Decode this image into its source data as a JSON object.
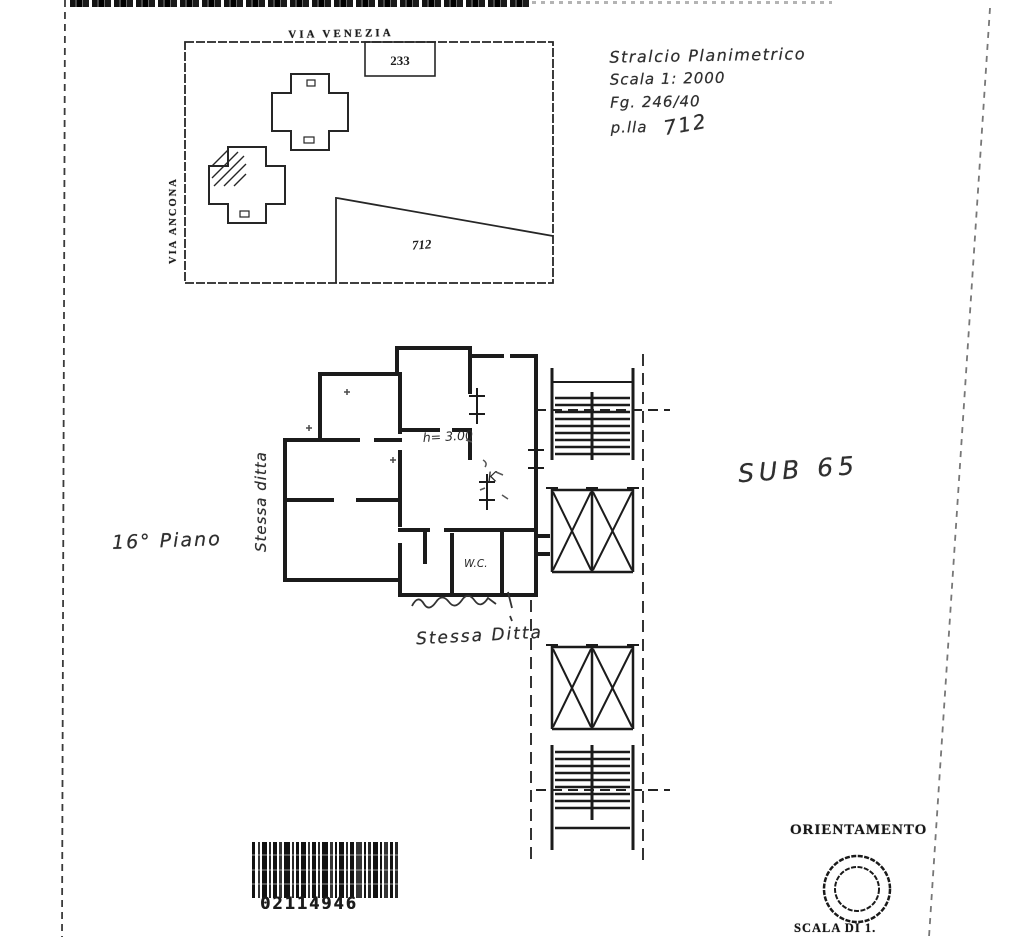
{
  "site_map": {
    "street_top_label": "VIA VENEZIA",
    "street_left_label": "VIA ANCONA",
    "building_number": "233",
    "parcel_number": "712"
  },
  "header_note": {
    "line1": "Stralcio Planimetrico",
    "line2": "Scala 1: 2000",
    "line3": "Fg. 246/40",
    "line4_label": "p.lla",
    "line4_value": "712"
  },
  "labels": {
    "sub": "SUB 65",
    "floor": "16° Piano",
    "same_owner_left": "Stessa ditta",
    "same_owner_bottom": "Stessa Ditta"
  },
  "floor_plan": {
    "height_label": "h= 3.00",
    "room_k_label": "K",
    "wc_label": "W.C."
  },
  "barcode": {
    "number": "02114946"
  },
  "compass": {
    "title": "ORIENTAMENTO",
    "scale_label": "SCALA DI 1."
  }
}
